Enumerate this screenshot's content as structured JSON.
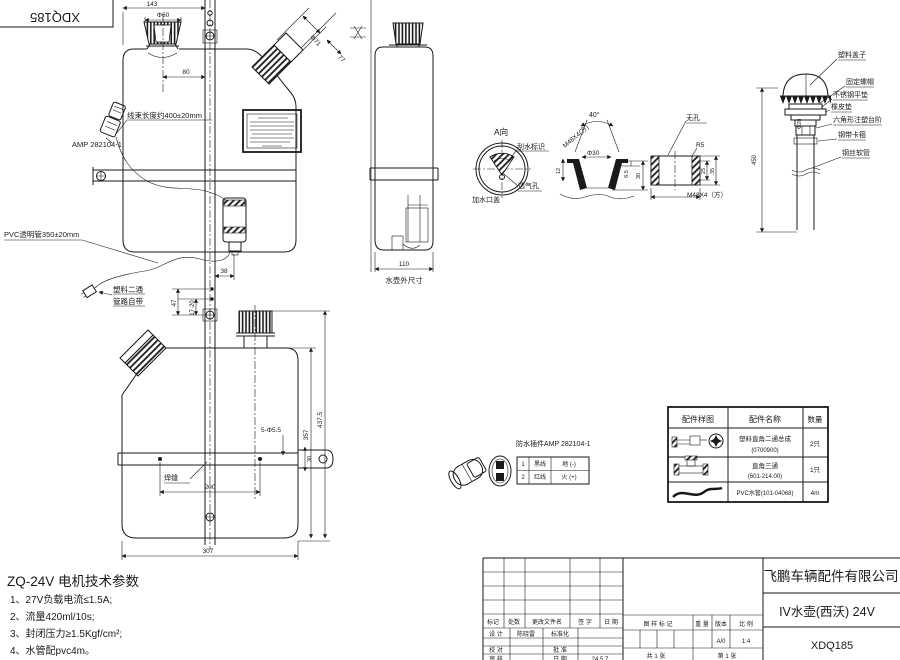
{
  "colors": {
    "ink": "#1a1a1a",
    "paper": "#ffffff"
  },
  "corner_stamp": "XDQ185",
  "front_view": {
    "dim_width": "143",
    "dim_cap": "Φ60",
    "dim_cap_offset": "80",
    "dim_spout_dia": "Φ71",
    "dim_spout_len": "77",
    "harness_note": "线束长度约400±20mm",
    "connector_note": "AMP 282104-1",
    "pvc_note": "PVC透明管350±20mm",
    "tee_note_1": "塑料二通",
    "tee_note_2": "管路自带",
    "dim_38": "38",
    "dim_47": "47",
    "dim_17_20": "17·20"
  },
  "rear_view": {
    "dim_height_total": "437.5",
    "dim_height_body": "357",
    "dim_holes": "5-Φ5.5",
    "dim_hole_span": "200",
    "dim_width": "307",
    "dim_bar": "30",
    "weld_note": "焊缝"
  },
  "side_view": {
    "dim_width": "110",
    "caption": "水壶外尺寸"
  },
  "detail_a": {
    "title": "A向",
    "wiper_label": "刮水标识",
    "vent_label": "透气孔",
    "cap_label": "加水口盖"
  },
  "cap_section": {
    "angle": "40°",
    "thread": "M48X4(方)",
    "dim_dia": "Φ30",
    "dim_depth": "12",
    "dim_step": "6.5",
    "dim_height": "30"
  },
  "plug_detail": {
    "note": "无孔",
    "radius": "R5",
    "dim_inner": "25",
    "dim_outer": "35",
    "thread": "M48X4（方）"
  },
  "cap_assembly": {
    "labels": [
      "塑料盖子",
      "固定螺帽",
      "不锈钢平垫",
      "橡皮垫",
      "六角形注塑台阶",
      "钢带卡箍",
      "钢丝软管"
    ],
    "dim_dia": "Φ28",
    "dim_length": "450"
  },
  "connector_detail": {
    "title": "防水插件AMP 282104-1",
    "pins": [
      {
        "no": "1",
        "wire": "黑线",
        "func": "地 (-)"
      },
      {
        "no": "2",
        "wire": "红线",
        "func": "火 (+)"
      }
    ]
  },
  "parts_table": {
    "headers": [
      "配件样图",
      "配件名称",
      "数量"
    ],
    "rows": [
      {
        "name": "塑料直角二通总成",
        "code": "(0700900)",
        "qty": "2只"
      },
      {
        "name": "直角三通",
        "code": "(601-214.00)",
        "qty": "1只"
      },
      {
        "name": "PVC水管(101-04068)",
        "code": "",
        "qty": "4m"
      }
    ]
  },
  "motor_specs": {
    "title": "ZQ-24V 电机技术参数",
    "items": [
      "1、27V负载电流≤1.5A;",
      "2、流量420ml/10s;",
      "3、封闭压力≥1.5Kgf/cm²;",
      "4、水管配pvc4m。"
    ]
  },
  "title_block": {
    "company": "飞鹏车辆配件有限公司",
    "product": "IV水壶(西沃) 24V",
    "code": "XDQ185",
    "rev_headers": [
      "标记",
      "处数",
      "更改文件名",
      "签 字",
      "日 期"
    ],
    "design_label": "设 计",
    "designer": "陈晓雷",
    "std_label": "标准化",
    "check_label": "校 对",
    "approve_label": "批 准",
    "audit_label": "审 核",
    "date_label": "日 期",
    "date": "24.5.7",
    "mark_label": "图 样 标 记",
    "weight_label": "重 量",
    "version_label": "版本",
    "scale_label": "比 例",
    "version": "A/0",
    "scale": "1:4",
    "sheets_total": "共 1 张",
    "sheet_no": "第 1 张"
  }
}
